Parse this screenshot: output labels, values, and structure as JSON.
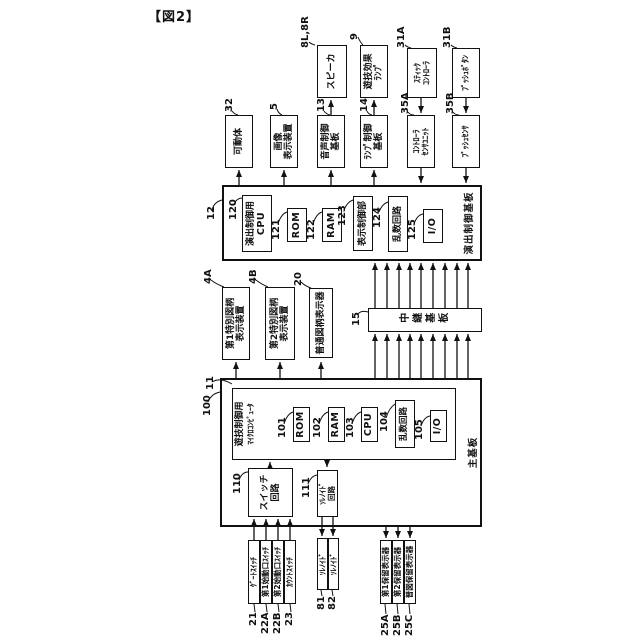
{
  "caption": "【図2】",
  "colors": {
    "ink": "#111111",
    "background": "#ffffff"
  },
  "boxes": {
    "speaker": {
      "ref": "8L,8R",
      "lines": [
        "スピーカ"
      ]
    },
    "effect_lamp": {
      "ref": "9",
      "lines": [
        "遊技効果",
        "ﾗﾝﾌﾟ"
      ]
    },
    "stick_controller": {
      "ref": "31A",
      "lines": [
        "ｽﾃｨｯｸ",
        "ｺﾝﾄﾛｰﾗ"
      ]
    },
    "push_button": {
      "ref": "31B",
      "lines": [
        "ﾌﾟｯｼｭﾎﾞﾀﾝ"
      ]
    },
    "movable_body": {
      "ref": "32",
      "lines": [
        "可動体"
      ]
    },
    "image_display": {
      "ref": "5",
      "lines": [
        "画像",
        "表示装置"
      ]
    },
    "audio_control_board": {
      "ref": "13",
      "lines": [
        "音声制御",
        "基板"
      ]
    },
    "lamp_control_board": {
      "ref": "14",
      "lines": [
        "ﾗﾝﾌﾟ制御",
        "基板"
      ]
    },
    "controller_sensor_unit": {
      "ref": "35A",
      "lines": [
        "ｺﾝﾄﾛｰﾗ",
        "ｾﾝｻﾕﾆｯﾄ"
      ]
    },
    "push_sensor": {
      "ref": "35B",
      "lines": [
        "ﾌﾟｯｼｭｾﾝｻ"
      ]
    },
    "effect_control_board": {
      "ref": "12",
      "label": "演出制御基板"
    },
    "effect_cpu": {
      "ref": "120",
      "lines": [
        "演出制御用",
        "CPU"
      ]
    },
    "effect_rom": {
      "ref": "121",
      "lines": [
        "ROM"
      ]
    },
    "effect_ram": {
      "ref": "122",
      "lines": [
        "RAM"
      ]
    },
    "display_control": {
      "ref": "123",
      "lines": [
        "表示制御部"
      ]
    },
    "effect_random": {
      "ref": "124",
      "lines": [
        "乱数回路"
      ]
    },
    "effect_io": {
      "ref": "125",
      "lines": [
        "I/O"
      ]
    },
    "special1_display": {
      "ref": "4A",
      "lines": [
        "第1特別図柄",
        "表示装置"
      ]
    },
    "special2_display": {
      "ref": "4B",
      "lines": [
        "第2特別図柄",
        "表示装置"
      ]
    },
    "normal_symbol_display": {
      "ref": "20",
      "lines": [
        "普通図柄表示器"
      ]
    },
    "relay_board": {
      "ref": "15",
      "label": "中継基板"
    },
    "main_board": {
      "ref": "100",
      "label": "主基板"
    },
    "game_micom": {
      "ref": "11",
      "lines": [
        "遊技制御用",
        "ﾏｲｸﾛｺﾝﾋﾟｭｰﾀ"
      ]
    },
    "main_rom": {
      "ref": "101",
      "lines": [
        "ROM"
      ]
    },
    "main_ram": {
      "ref": "102",
      "lines": [
        "RAM"
      ]
    },
    "main_cpu": {
      "ref": "103",
      "lines": [
        "CPU"
      ]
    },
    "main_random": {
      "ref": "104",
      "lines": [
        "乱数回路"
      ]
    },
    "main_io": {
      "ref": "105",
      "lines": [
        "I/O"
      ]
    },
    "switch_circuit": {
      "ref": "110",
      "lines": [
        "スイッチ",
        "回路"
      ]
    },
    "solenoid_circuit": {
      "ref": "111",
      "lines": [
        "ｿﾚﾉｲﾄﾞ",
        "回路"
      ]
    },
    "gate_switch": {
      "ref": "21",
      "lines": [
        "ｹﾞｰﾄｽｲｯﾁ"
      ]
    },
    "start1_switch": {
      "ref": "22A",
      "lines": [
        "第1始動口ｽｲｯﾁ"
      ]
    },
    "start2_switch": {
      "ref": "22B",
      "lines": [
        "第2始動口ｽｲｯﾁ"
      ]
    },
    "count_switch": {
      "ref": "23",
      "lines": [
        "ｶｳﾝﾄｽｲｯﾁ"
      ]
    },
    "solenoid_81": {
      "ref": "81",
      "lines": [
        "ｿﾚﾉｲﾄﾞ"
      ]
    },
    "solenoid_82": {
      "ref": "82",
      "lines": [
        "ｿﾚﾉｲﾄﾞ"
      ]
    },
    "hold1_display": {
      "ref": "25A",
      "lines": [
        "第1保留表示器"
      ]
    },
    "hold2_display": {
      "ref": "25B",
      "lines": [
        "第2保留表示器"
      ]
    },
    "normal_hold_display": {
      "ref": "25C",
      "lines": [
        "普図保留表示器"
      ]
    }
  }
}
